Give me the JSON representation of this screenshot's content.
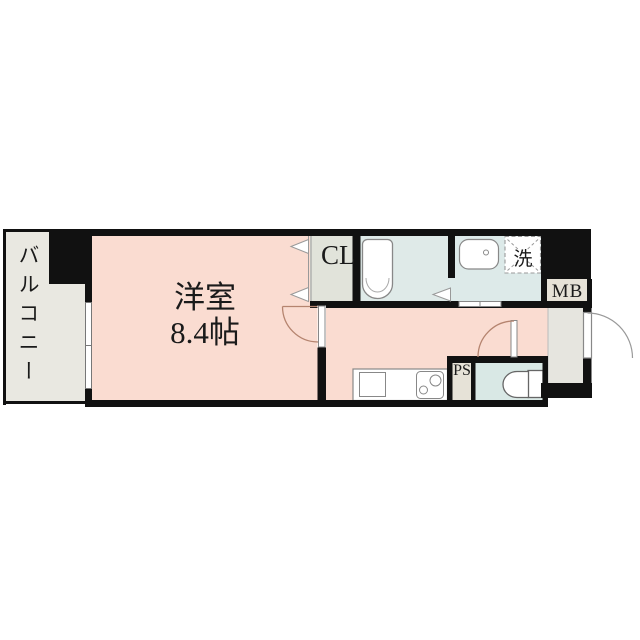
{
  "floor_plan": {
    "balcony_label": "バルコニー",
    "room_name": "洋室",
    "room_size": "8.4帖",
    "closet_label": "CL",
    "washer_label": "洗",
    "meter_box_label": "MB",
    "pipe_space_label": "PS"
  },
  "colors": {
    "room_pink": "#fadcd1",
    "balcony_gray": "#e9e8e1",
    "closet_gray": "#e1e3da",
    "bath_blue": "#dfeae8",
    "washroom_blue": "#ddeae9",
    "toilet_blue": "#d9e8e5",
    "entrance_gray": "#e6e5df",
    "box_beige": "#e6e2d7",
    "wall_black": "#111111"
  }
}
